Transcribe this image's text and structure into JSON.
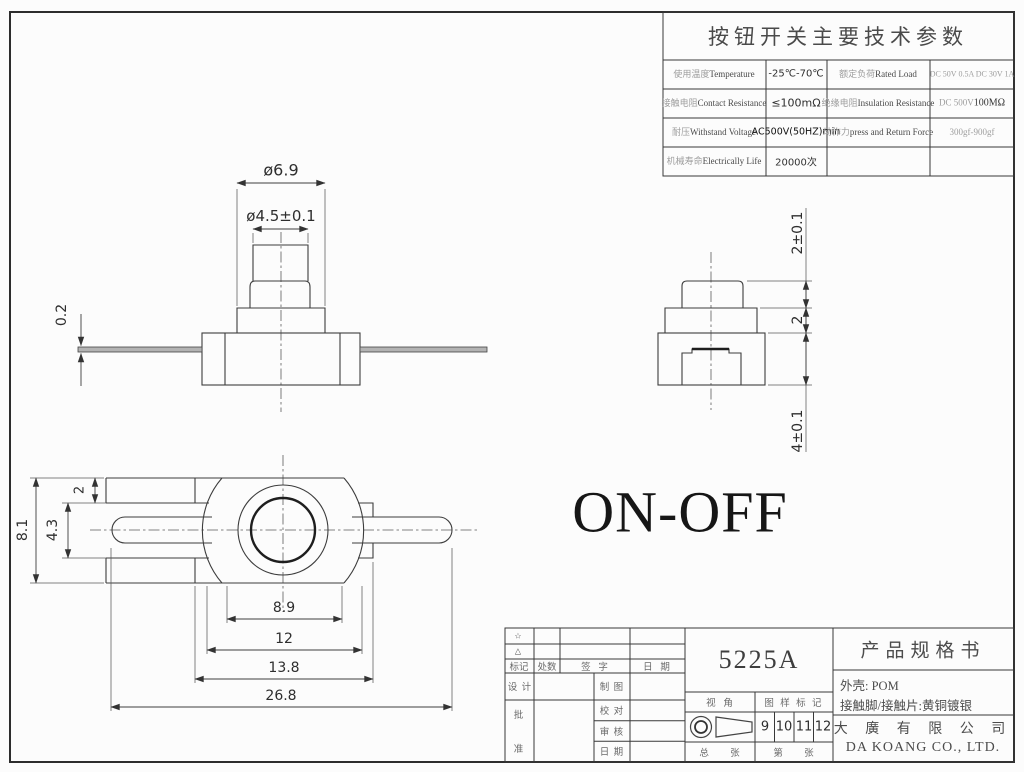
{
  "params_table": {
    "title": "按钮开关主要技术参数",
    "rows": [
      {
        "label1_zh": "使用温度",
        "label1_en": "Temperature",
        "value1": "-25℃-70℃",
        "label2_zh": "额定负荷",
        "label2_en": "Rated Load",
        "value2": "DC 50V 0.5A DC 30V 1A"
      },
      {
        "label1_zh": "接触电阻",
        "label1_en": "Contact Resistance",
        "value1": "≤100mΩ",
        "label2_zh": "绝缘电阻",
        "label2_en": "Insulation Resistance",
        "value2_a": "DC 500V",
        "value2_b": "100MΩ"
      },
      {
        "label1_zh": "耐压",
        "label1_en": "Withstand Voltage",
        "value1": "AC500V(50HZ)min",
        "label2_zh": "动作力",
        "label2_en": "press and Return Force",
        "value2": "300gf-900gf"
      },
      {
        "label1_zh": "机械寿命",
        "label1_en": "Electrically Life",
        "value1": "20000次",
        "label2_zh": "",
        "label2_en": "",
        "value2": ""
      }
    ]
  },
  "views": {
    "on_off": "ON-OFF",
    "front": {
      "dia_outer": "ø6.9",
      "dia_inner": "ø4.5±0.1",
      "lead_thickness": "0.2"
    },
    "side": {
      "plunger_height": "2±0.1",
      "mid_height": "2",
      "base_height": "4±0.1"
    },
    "top": {
      "total_height": "8.1",
      "slot_height": "4.3",
      "edge_offset": "2",
      "boss_width": "8.9",
      "body_width": "12",
      "body_overall": "13.8",
      "total_length": "26.8"
    }
  },
  "title_block": {
    "revision": {
      "star": "☆",
      "triangle": "△",
      "mark": "标记",
      "count": "处数",
      "signature": "签  字",
      "date": "日  期"
    },
    "roles": {
      "design": "设 计",
      "draft": "制 图",
      "proof": "校 对",
      "review": "审 核",
      "date": "日 期",
      "approve_1": "批",
      "approve_2": "准"
    },
    "drawing_no": "5225A",
    "view_angle": "视  角",
    "pattern_mark": "图 样 标 记",
    "marks": [
      "9",
      "10",
      "11",
      "12"
    ],
    "total_sheet": "总      张",
    "sheet_no": "第      张",
    "spec_title": "产品规格书",
    "material_1": "外壳: POM",
    "material_2": "接触脚/接触片:黄铜镀银",
    "company_zh": "大 廣 有 限 公 司",
    "company_en": "DA KOANG CO., LTD."
  }
}
